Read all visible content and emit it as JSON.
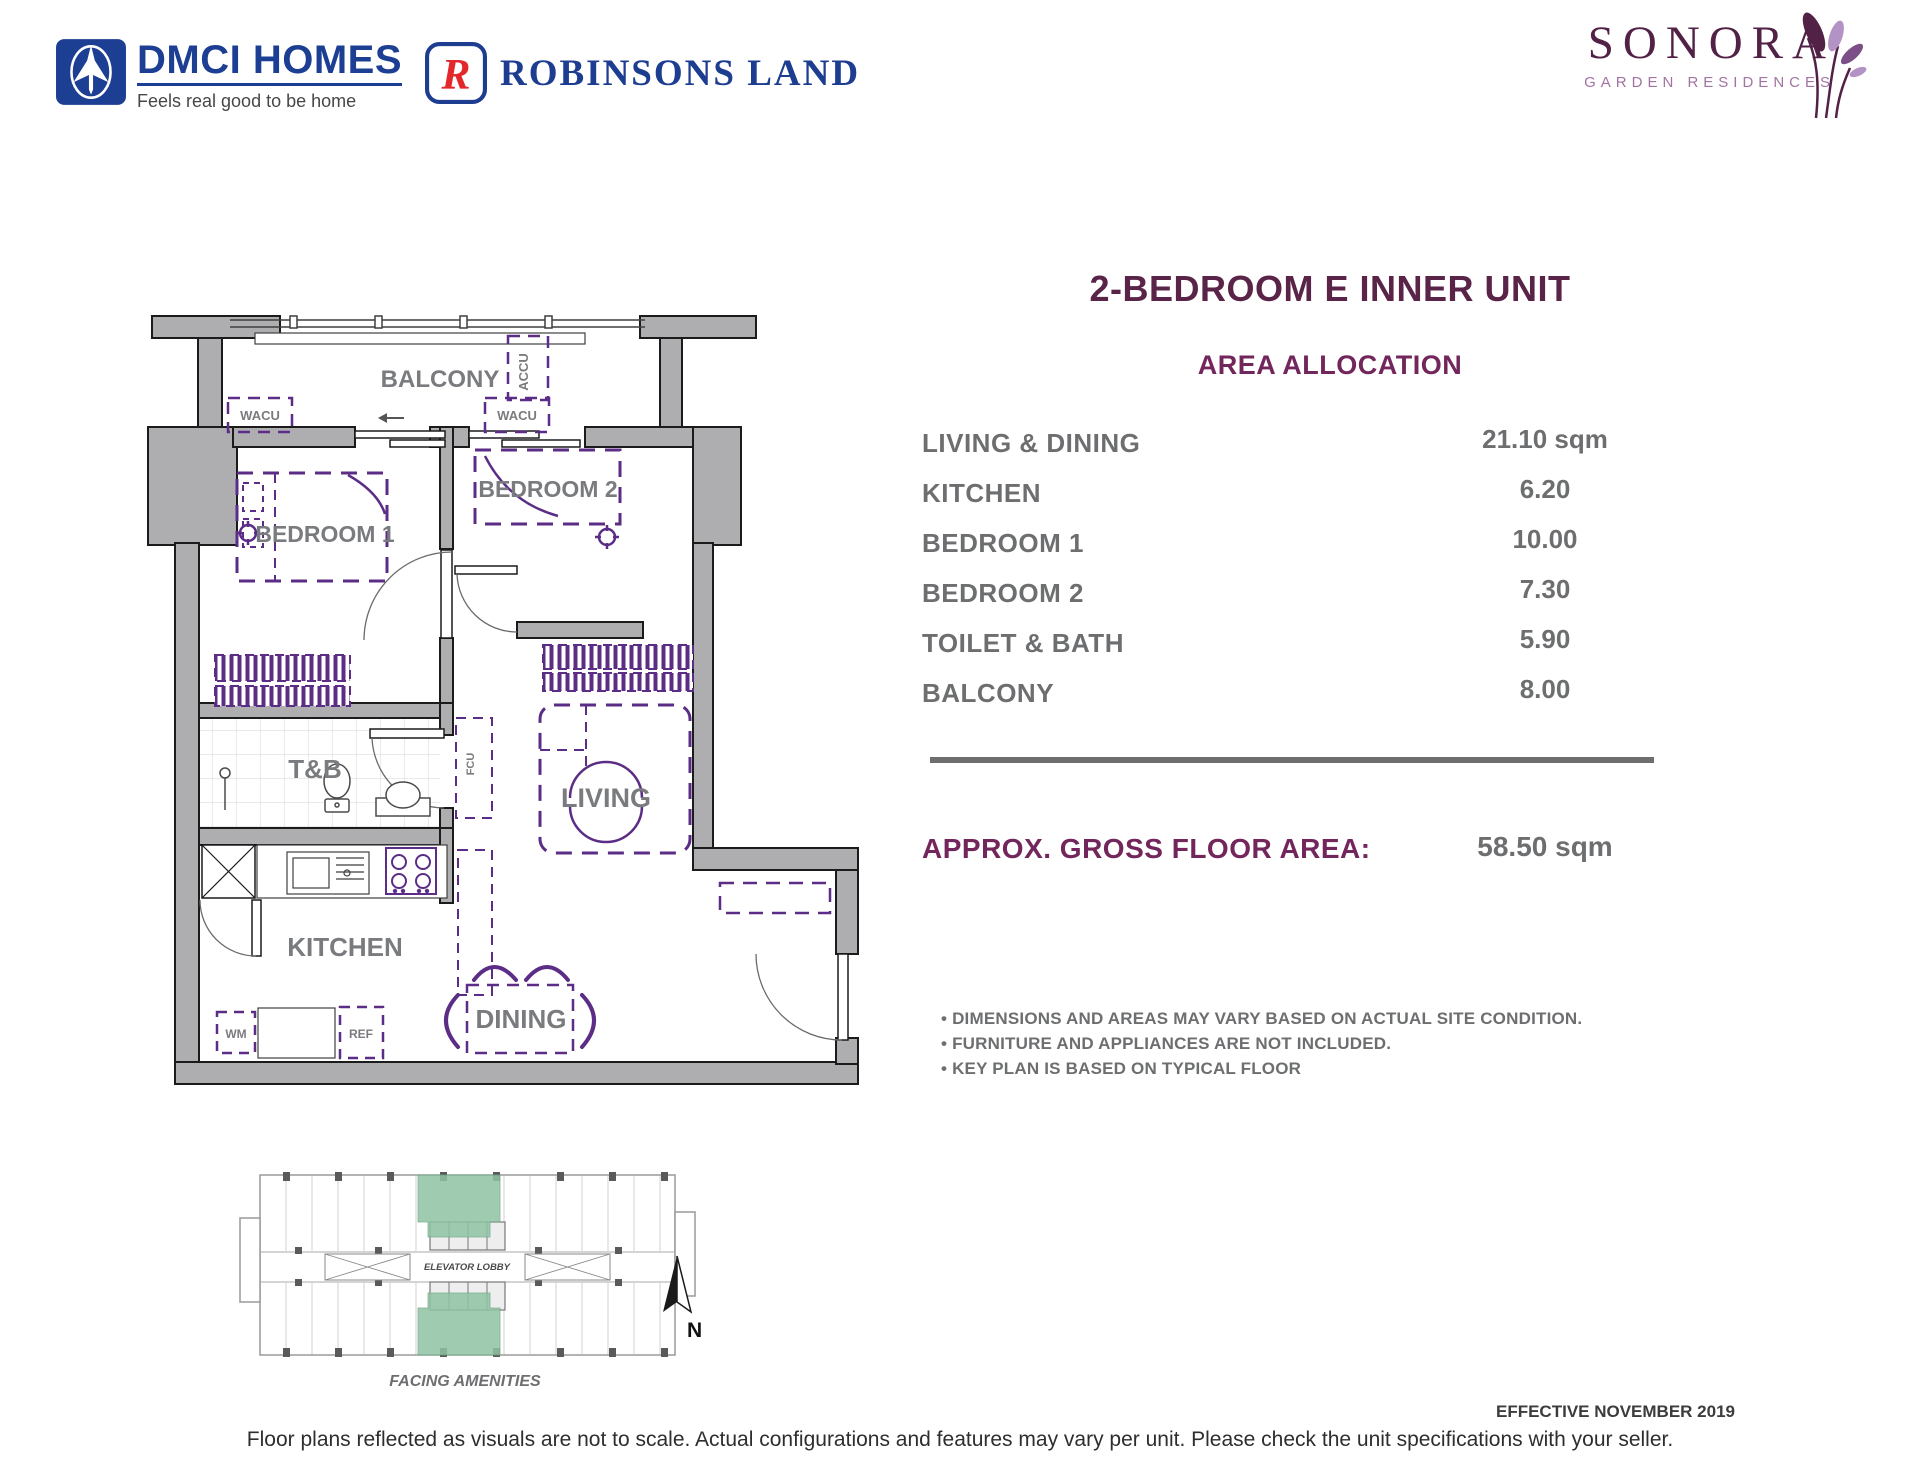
{
  "header": {
    "dmci": {
      "name": "DMCI HOMES",
      "tagline": "Feels real good to be home"
    },
    "robinsons": {
      "name": "ROBINSONS LAND",
      "logo_letter": "R"
    },
    "sonora": {
      "name": "SONORA",
      "subname": "GARDEN RESIDENCES"
    }
  },
  "unit": {
    "title": "2-BEDROOM E INNER UNIT",
    "section_title": "AREA ALLOCATION",
    "areas": [
      {
        "label": "LIVING & DINING",
        "value": "21.10 sqm"
      },
      {
        "label": "KITCHEN",
        "value": "6.20"
      },
      {
        "label": "BEDROOM 1",
        "value": "10.00"
      },
      {
        "label": "BEDROOM 2",
        "value": "7.30"
      },
      {
        "label": "TOILET & BATH",
        "value": "5.90"
      },
      {
        "label": "BALCONY",
        "value": "8.00"
      }
    ],
    "gross": {
      "label": "APPROX. GROSS FLOOR AREA:",
      "value": "58.50 sqm"
    },
    "notes": [
      "• DIMENSIONS AND AREAS MAY VARY BASED ON ACTUAL SITE CONDITION.",
      "• FURNITURE AND APPLIANCES ARE NOT INCLUDED.",
      "• KEY PLAN IS BASED ON TYPICAL FLOOR"
    ]
  },
  "floorplan": {
    "labels": {
      "balcony": "BALCONY",
      "accu": "ACCU",
      "wacu_left": "WACU",
      "wacu_right": "WACU",
      "bedroom1": "BEDROOM 1",
      "bedroom2": "BEDROOM 2",
      "tb": "T&B",
      "fcu": "FCU",
      "living": "LIVING",
      "kitchen": "KITCHEN",
      "wm": "WM",
      "ref": "REF",
      "dining": "DINING"
    }
  },
  "keyplan": {
    "elevator_lobby": "ELEVATOR LOBBY",
    "caption": "FACING AMENITIES",
    "north": "N"
  },
  "footer": {
    "effective": "EFFECTIVE NOVEMBER 2019",
    "disclaimer": "Floor plans reflected as visuals are not to scale. Actual configurations and features may vary per unit. Please check the unit specifications with your seller."
  },
  "colors": {
    "plum_title": "#5A2348",
    "area_heading": "#73265C",
    "text_grey": "#6D6E70",
    "plan_purple": "#5B2D86",
    "wall_grey": "#AEAEB0",
    "dmci_blue": "#1C3F94",
    "robinsons_blue": "#1D3D91",
    "robinsons_red": "#E3272A",
    "sonora_dark": "#522146",
    "sonora_light": "#A273A3",
    "keyplan_green": "#8FC3A3"
  }
}
